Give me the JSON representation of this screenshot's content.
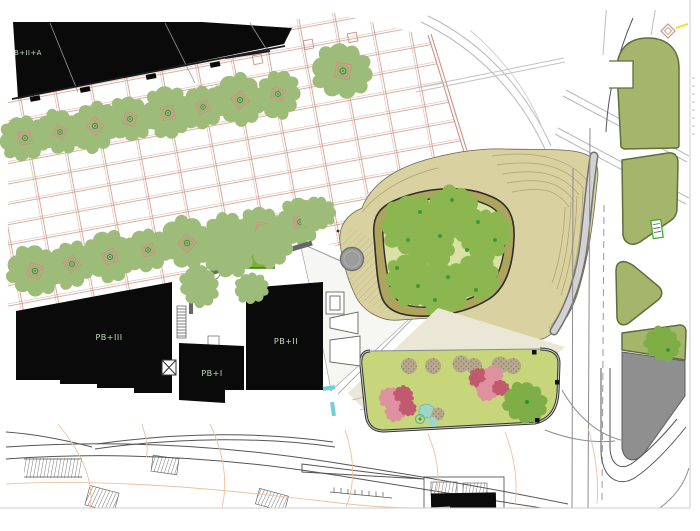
{
  "plan": {
    "labels": {
      "block_a": "B+II+A",
      "pb3": "PB+III",
      "pb1": "PB+I",
      "pb2": "PB+II"
    },
    "palette": {
      "ink": "#0a0a0a",
      "label": "#c3dec3",
      "salmon": "#cc9180",
      "tree": "#9dbc7a",
      "tree-dark": "#8cb750",
      "lawn-park": "#d9e2a4",
      "loop-fill": "#aea45e",
      "mound": "#d9d2a0",
      "contour": "#b3a977",
      "island": "#a5b56c",
      "island-edge": "#5f6e3c",
      "lawn-bed": "#c7d57b",
      "grey-pave": "#8f8f8f",
      "orange": "#edc19c",
      "flower": "#e0919f",
      "flower-dark": "#c15a6e",
      "teal": "#9fd6c8",
      "shrub": "#b5a88e",
      "cyan": "#6fd0d6",
      "beige": "#ebe7d6"
    }
  }
}
